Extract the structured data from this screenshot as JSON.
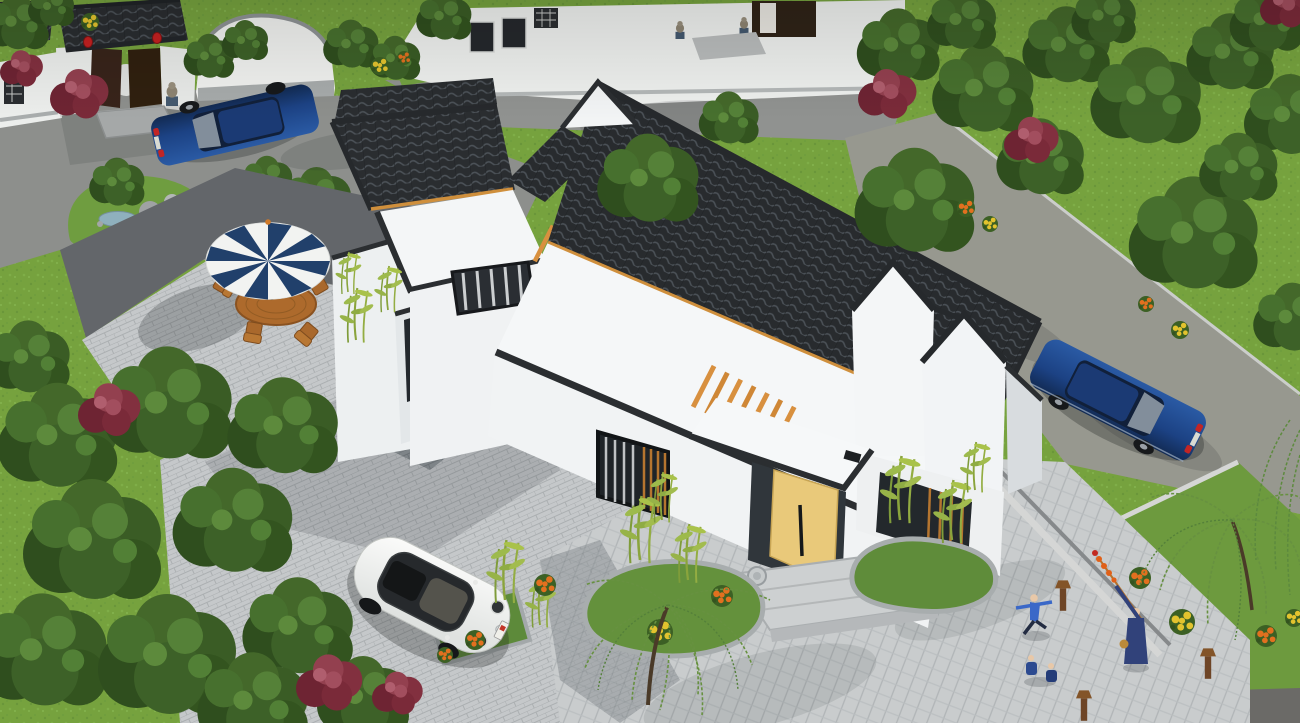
{
  "scene": {
    "label": "Aerial 3D rendering of a Chinese-style single-storey courtyard house with white walls and dark grey tiled roofs, set in a landscaped residential compound",
    "view": "high-angle aerial, daytime",
    "style": "modern Chinese (white stucco, charcoal tile, timber pergolas)"
  },
  "colors": {
    "grass": "#76a23e",
    "foliage_dark": "#2f4e1e",
    "foliage_red": "#82303f",
    "roof_tile": "#282b2e",
    "wall_white": "#f4f6f7",
    "pavement_light": "#c9cccd",
    "road_gray": "#8d8f8c",
    "asphalt_dark": "#63666a",
    "timber_orange": "#d8903f",
    "door_tan": "#e9c97a",
    "umbrella_navy": "#21406b",
    "umbrella_white": "#f2f3f1",
    "car_blue": "#1c4284",
    "car_white": "#f3f4f2",
    "flower_orange": "#e2701f",
    "flower_yellow": "#e3c32e",
    "lantern_red": "#c42121",
    "pond_blue": "#8fb0bd",
    "stone_gray": "#c6cacb"
  },
  "objects": {
    "main_house": {
      "label": "Main courtyard house with large sloped tile roof, flat white roof terraces and gabled wing"
    },
    "entrance": {
      "label": "Entrance portico with open light-wood door, timber pergola and stone drum bases"
    },
    "left_wing": {
      "label": "Left wing with tiled roof, flat terrace and curtained windows"
    },
    "right_gables": {
      "label": "Right wing with twin white gable walls and dark coping"
    },
    "courtyard_paving": {
      "label": "Light stone-paved courtyard and herringbone plaza"
    },
    "umbrella_set": {
      "label": "Blue-and-white striped patio umbrella with wooden table",
      "chairs": 4
    },
    "gate": {
      "label": "Traditional compound gate with dark timber doors",
      "lanterns": 2,
      "stone_lions": 2
    },
    "rock_garden": {
      "label": "Rock garden with small pond"
    },
    "vehicles": {
      "white_beetle": {
        "label": "White compact car parked in the courtyard",
        "color": "#f3f4f2"
      },
      "blue_sedan_road": {
        "label": "Dark blue sedan parked on the right-hand road",
        "color": "#1c4284"
      },
      "blue_sedan_gate": {
        "label": "Dark blue sedan parked by the compound gate",
        "color": "#1c4284"
      }
    },
    "people": {
      "dancer": {
        "label": "Person in blue exercising on the plaza"
      },
      "elder": {
        "label": "Elder in blue holding a pole of candied haws"
      },
      "children": {
        "label": "Two children sitting on the plaza",
        "count": 2
      }
    },
    "landscaping": {
      "trees": {
        "label": "Dense green trees and red-leaf ornamentals"
      },
      "bamboo": {
        "label": "Bamboo clumps along the house walls"
      },
      "willows": {
        "label": "Weeping willows by the plaza"
      },
      "flower_colors": [
        "orange",
        "yellow",
        "red"
      ]
    }
  }
}
